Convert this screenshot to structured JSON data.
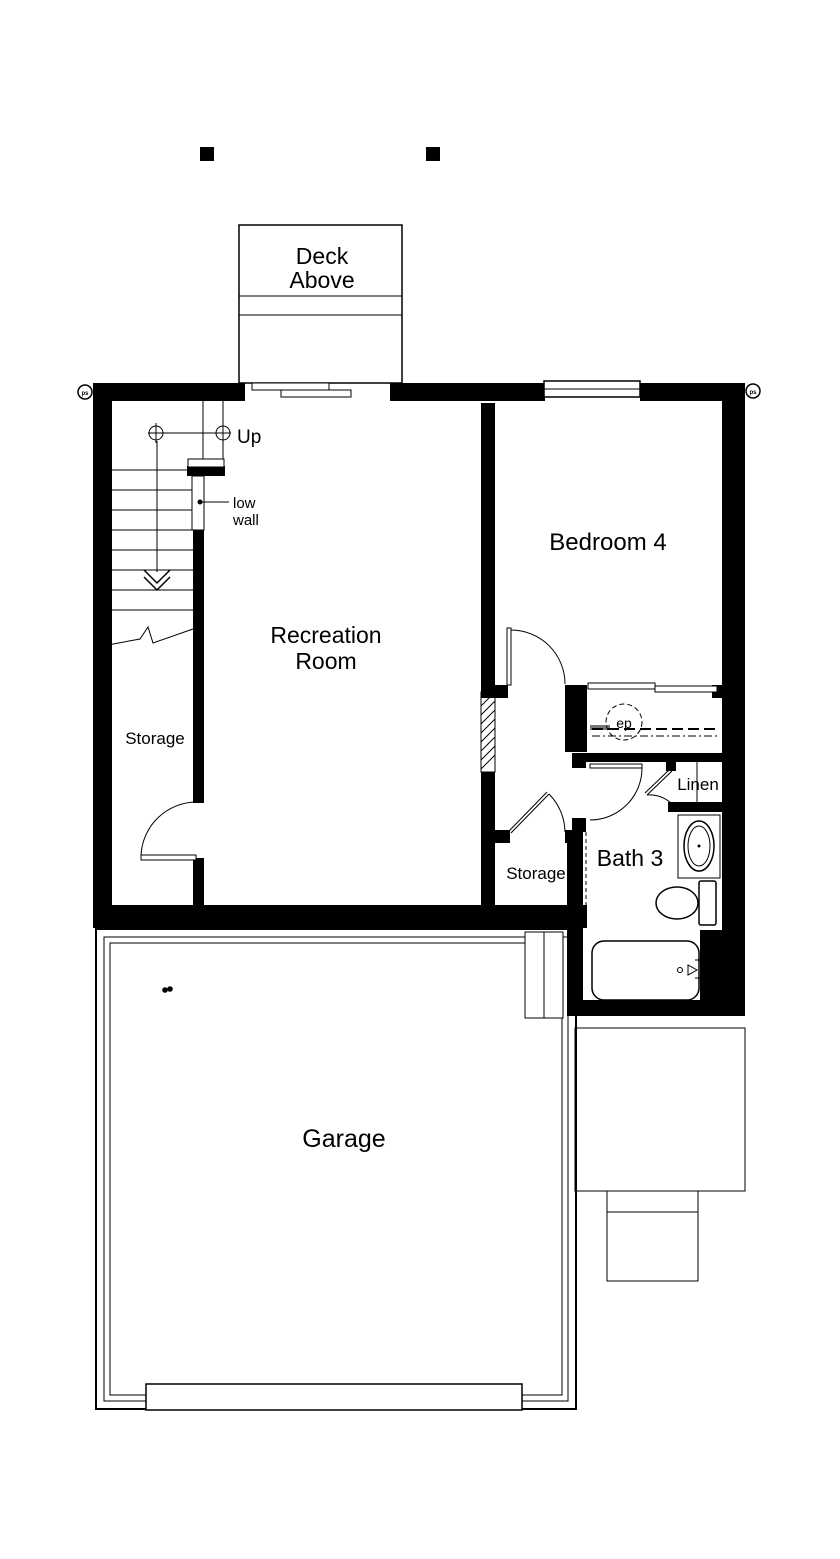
{
  "plan": {
    "type": "basement-floor-plan",
    "background": "#ffffff",
    "wall_color": "#000000",
    "accent_gray": "#777777"
  },
  "labels": {
    "deck": {
      "line1": "Deck",
      "line2": "Above"
    },
    "up": "Up",
    "low_wall": {
      "line1": "low",
      "line2": "wall"
    },
    "recreation": {
      "line1": "Recreation",
      "line2": "Room"
    },
    "bedroom4": "Bedroom 4",
    "storage_left": "Storage",
    "storage_center": "Storage",
    "bath3": "Bath 3",
    "linen": "Linen",
    "ep": "ep",
    "garage": "Garage",
    "corner_marker_left": "ps",
    "corner_marker_right": "ps"
  }
}
